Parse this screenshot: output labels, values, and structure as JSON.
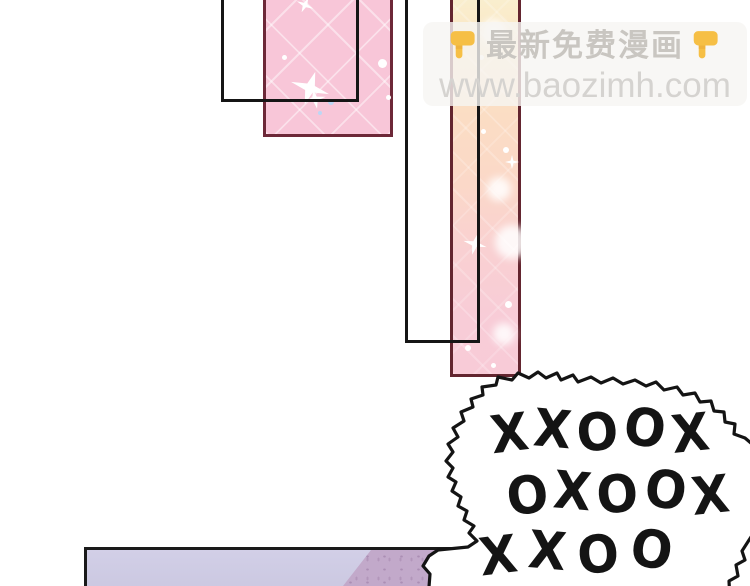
{
  "page": {
    "background": "#ffffff"
  },
  "watermark": {
    "line1": "最新免费漫画",
    "line2": "www.baozimh.com",
    "hand_icon": "backhand-index-pointing-down",
    "colors": {
      "box_bg": "rgba(246,245,243,0.8)",
      "line1_text": "#c9c6c1",
      "line2_text": "#d5d3d0",
      "hand": "#f6bf45"
    }
  },
  "speech_bubble": {
    "lines": [
      "XXOOX",
      "OXOOX",
      "XXOO"
    ],
    "stroke": "#141414",
    "fill": "#ffffff"
  },
  "panels": {
    "pink_tile": {
      "fill": "#f8c6d8",
      "border": "#6d2838",
      "pattern": "diagonal-tiles-with-sparkles"
    },
    "gradient_strip": {
      "border": "#63252f",
      "gradient": [
        "#f9efcf",
        "#fbe4c2",
        "#fbd8c8",
        "#f8cbd7"
      ]
    },
    "outline_rect_small": {
      "border": "#151515"
    },
    "outline_rect_tall": {
      "border": "#151515"
    },
    "floor": {
      "fill_left": "#cdcae3",
      "fill_right": "#c2a9ca",
      "border": "#1a1a1a"
    }
  }
}
